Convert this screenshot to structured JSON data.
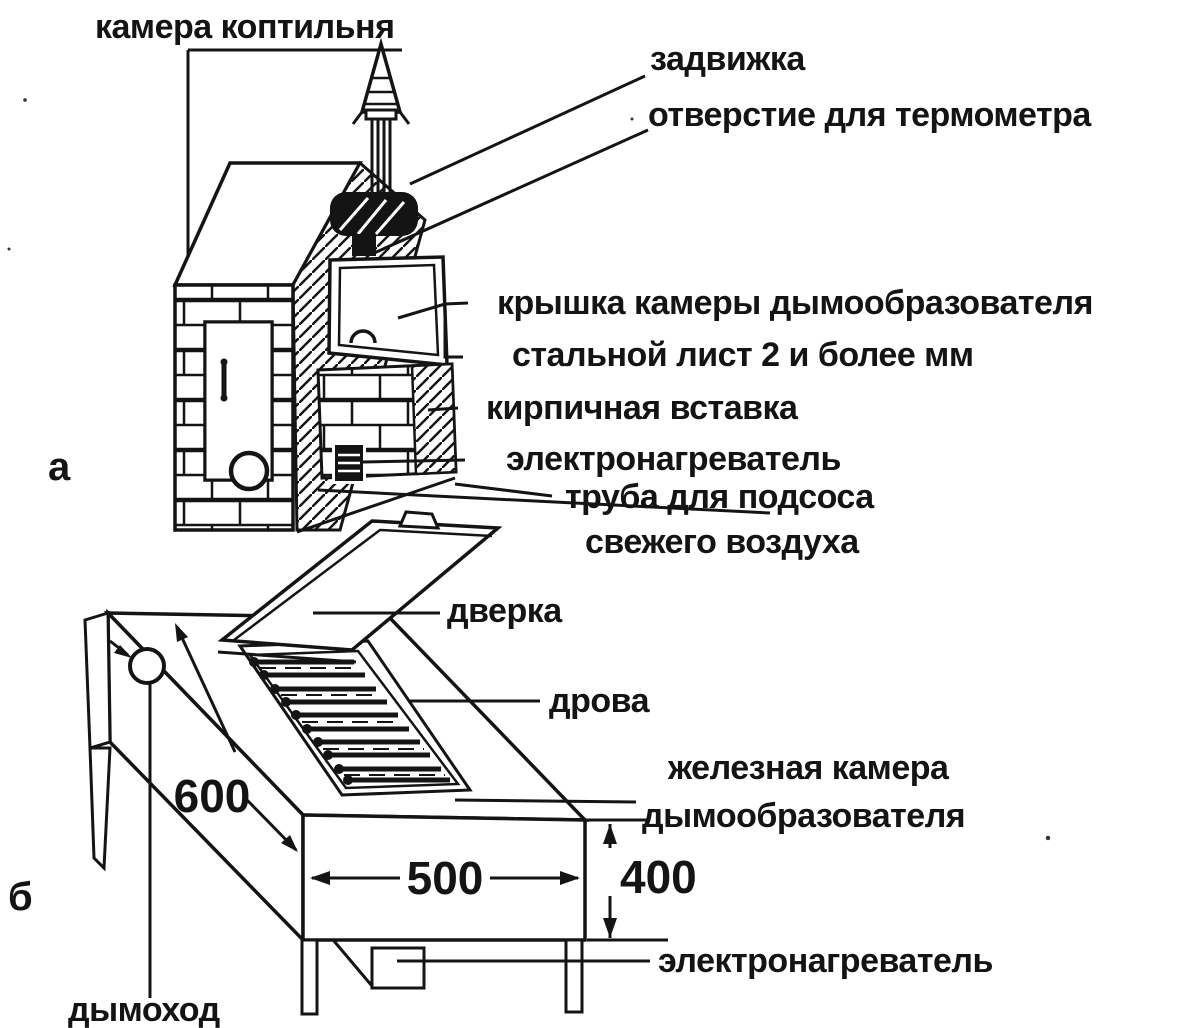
{
  "figure": {
    "title_label": "камера коптильня",
    "part_a_marker": "а",
    "part_b_marker": "б",
    "labels": {
      "damper": "задвижка",
      "thermometer_hole": "отверстие для термометра",
      "smoke_chamber_lid": "крышка камеры дымообразователя",
      "steel_sheet": "стальной лист 2 и более мм",
      "brick_insert": "кирпичная вставка",
      "heater_a": "электронагреватель",
      "air_intake_line1": "труба для подсоса",
      "air_intake_line2": "свежего воздуха",
      "door": "дверка",
      "firewood": "дрова",
      "iron_chamber_line1": "железная камера",
      "iron_chamber_line2": "дымообразователя",
      "heater_b": "электронагреватель",
      "chimney": "дымоход"
    },
    "dimensions": {
      "length_mm": "600",
      "width_mm": "500",
      "height_mm": "400"
    },
    "colors": {
      "ink": "#141414",
      "paper": "#ffffff"
    }
  }
}
